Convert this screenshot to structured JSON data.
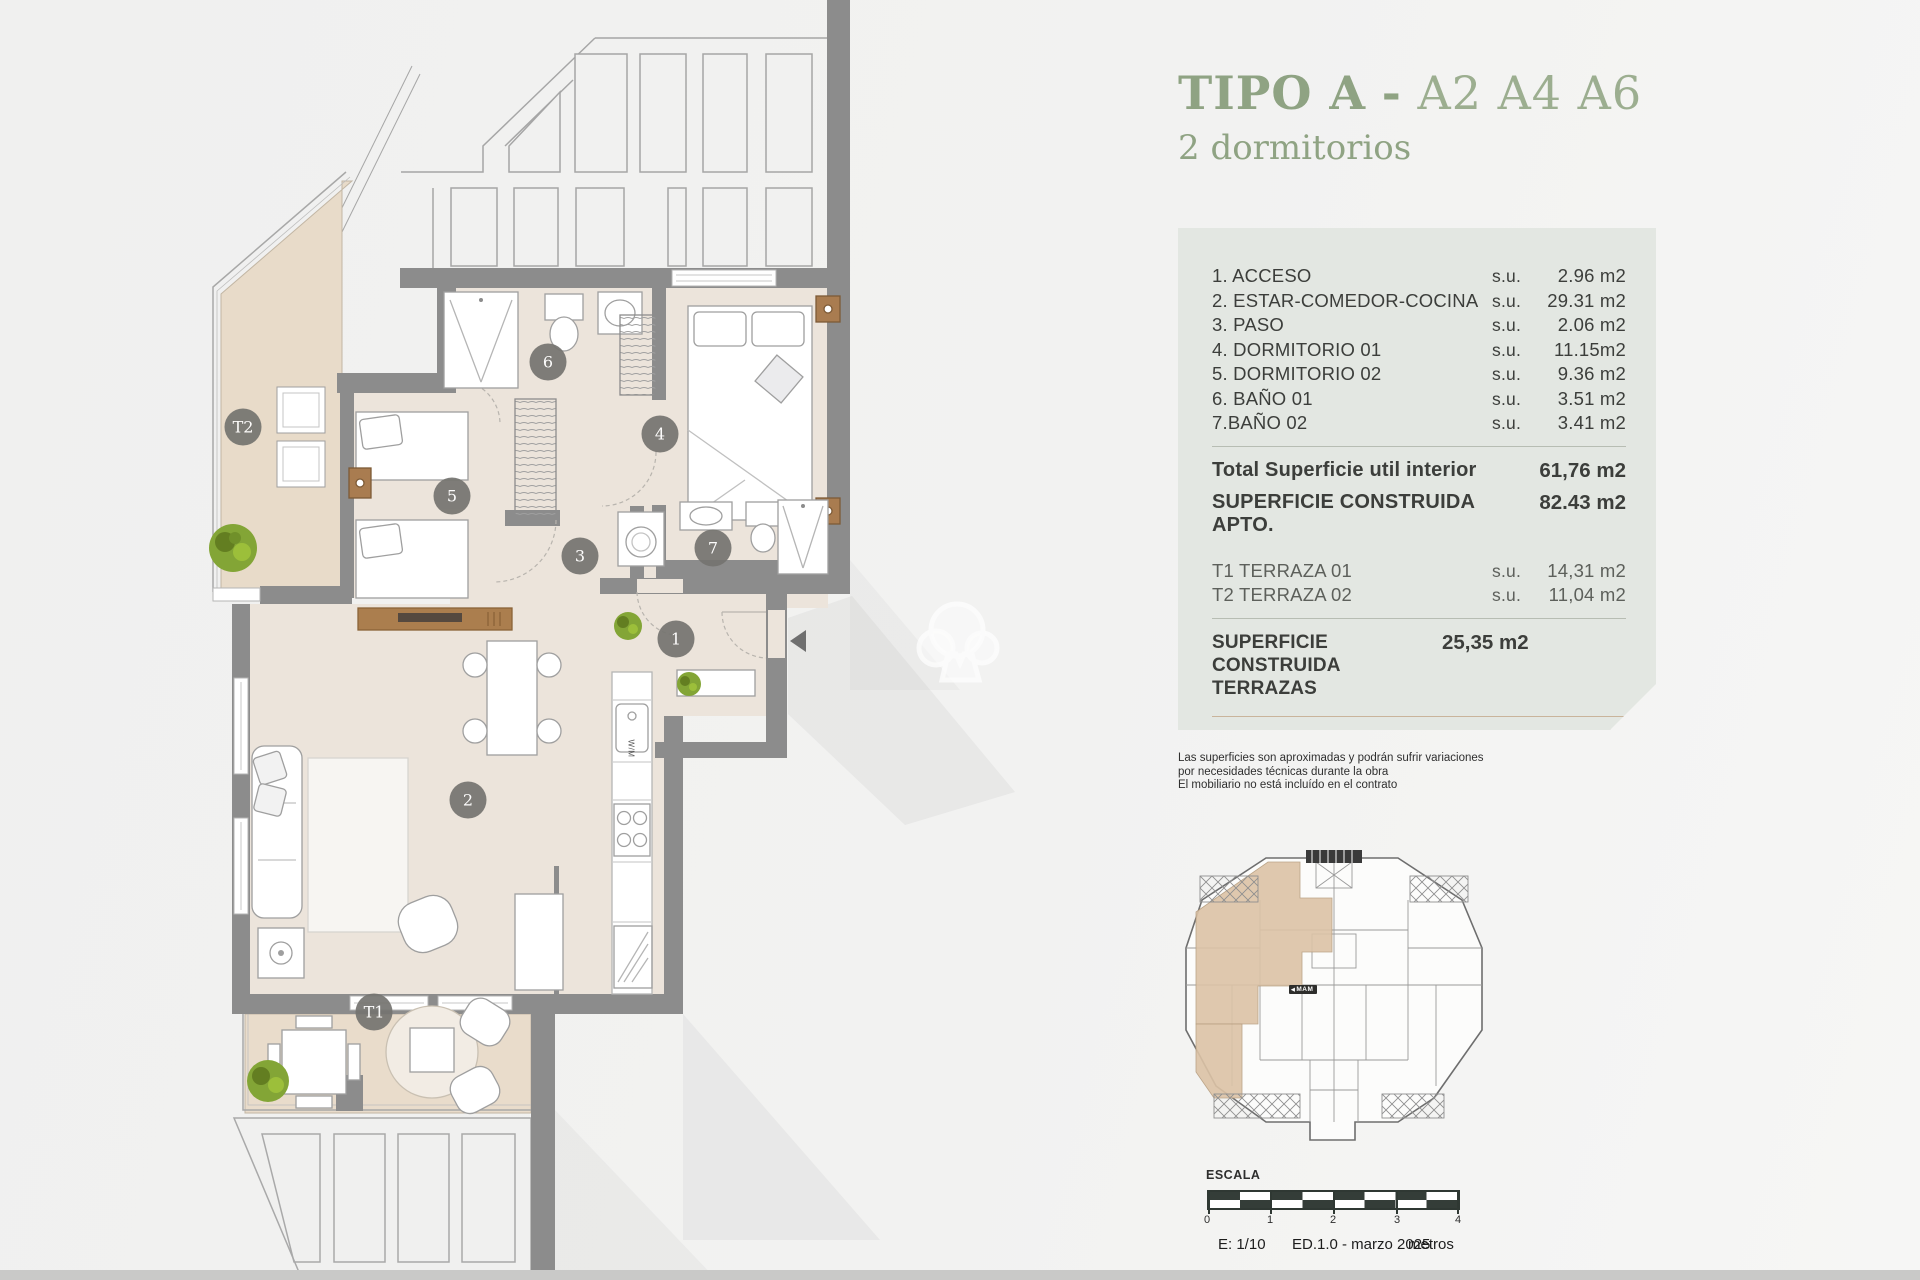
{
  "colors": {
    "accent_green": "#8fa383",
    "accent_orange": "#c98f58",
    "panel_bg": "#e3e7e2",
    "wall_grey": "#8c8c8c",
    "terrace_beige": "#e8dbc9",
    "floor_beige": "#ece4db",
    "badge_grey": "#757470",
    "scalebar_dark": "#343d38"
  },
  "title": {
    "main": "TIPO A",
    "dash": "-",
    "codes": "A2 A4 A6",
    "subtitle": "2 dormitorios"
  },
  "panel": {
    "rooms": [
      {
        "label": "1. ACCESO",
        "su": "s.u.",
        "value": "2.96 m2"
      },
      {
        "label": "2. ESTAR-COMEDOR-COCINA",
        "su": "s.u.",
        "value": "29.31 m2"
      },
      {
        "label": "3. PASO",
        "su": "s.u.",
        "value": "2.06 m2"
      },
      {
        "label": "4. DORMITORIO 01",
        "su": "s.u.",
        "value": "11.15m2"
      },
      {
        "label": "5. DORMITORIO 02",
        "su": "s.u.",
        "value": "9.36 m2"
      },
      {
        "label": "6. BAÑO 01",
        "su": "s.u.",
        "value": "3.51 m2"
      },
      {
        "label": "7.BAÑO 02",
        "su": "s.u.",
        "value": "3.41 m2"
      }
    ],
    "total_util": {
      "label": "Total Superficie util interior",
      "value": "61,76 m2"
    },
    "construida": {
      "label": "SUPERFICIE CONSTRUIDA APTO.",
      "value": "82.43 m2"
    },
    "terraces": [
      {
        "label": "T1 TERRAZA 01",
        "su": "s.u.",
        "value": "14,31 m2"
      },
      {
        "label": "T2 TERRAZA 02",
        "su": "s.u.",
        "value": "11,04 m2"
      }
    ],
    "construida_terrazas": {
      "label": "SUPERFICIE CONSTRUIDA TERRAZAS",
      "value": "25,35 m2"
    },
    "total": {
      "label": "SUPERFICIE TOTAL APARTAMENTO",
      "value": "107,78 m2"
    }
  },
  "disclaimer": {
    "line1": "Las superficies son aproximadas y podrán sufrir variaciones",
    "line2": "por necesidades técnicas durante la obra",
    "line3": "El mobiliario no está incluído en el contrato"
  },
  "plan": {
    "badges": [
      {
        "label": "T2"
      },
      {
        "label": "6"
      },
      {
        "label": "4"
      },
      {
        "label": "5"
      },
      {
        "label": "3"
      },
      {
        "label": "7"
      },
      {
        "label": "1"
      },
      {
        "label": "2"
      },
      {
        "label": "T1"
      }
    ],
    "kitchen_label": "W/M"
  },
  "keyplan": {
    "logo": "MAM",
    "arrow": "◀"
  },
  "scalebar": {
    "title": "ESCALA",
    "ticks": [
      "0",
      "1",
      "2",
      "3",
      "4"
    ],
    "scale": "E: 1/10",
    "edition": "ED.1.0 - marzo 2025",
    "unit": "metros"
  }
}
